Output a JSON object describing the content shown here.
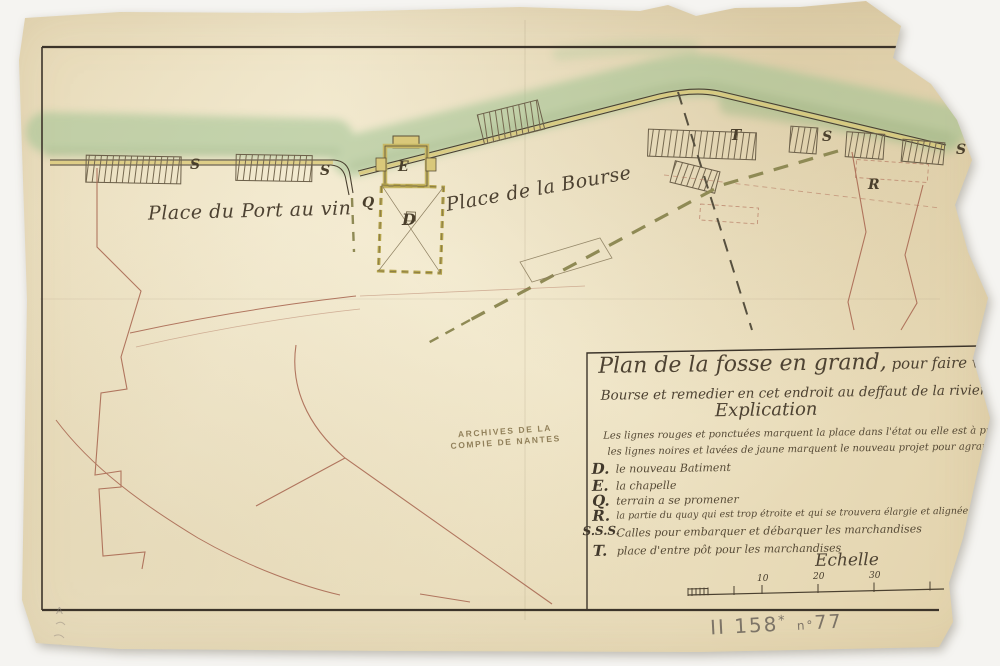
{
  "map_labels": {
    "place_port_au_vin": "Place du Port au vin",
    "place_de_la_bourse": "Place de la Bourse",
    "s_left_1": "S",
    "s_left_2": "S",
    "chapel_e": "E",
    "promenade_q": "Q",
    "building_d": "D",
    "entrepot_t": "T",
    "s_right_1": "S",
    "quay_r": "R",
    "s_right_2": "S"
  },
  "stamp": {
    "line1": "ARCHIVES DE LA",
    "line2": "COMPIE DE NANTES"
  },
  "title_block": {
    "title_line1_big": "Plan de la fosse en grand,",
    "title_line1_rest": " pour faire voir la maniere",
    "title_line2": "Bourse et remedier en cet endroit au deffaut de la riviere comme il est dit d",
    "heading": "Explication",
    "intro_line1": "Les lignes rouges et ponctuées marquent la place dans l'état ou elle est à présent,",
    "intro_line2": "les lignes noires et lavées de jaune marquent le nouveau projet pour agrandir c",
    "legend": [
      {
        "key": "D.",
        "text": "le nouveau Batiment"
      },
      {
        "key": "E.",
        "text": "la chapelle"
      },
      {
        "key": "Q.",
        "text": "terrain a se promener"
      },
      {
        "key": "R.",
        "text": "la partie du quay qui est trop étroite et qui se trouvera élargie et alignée par le nouv"
      },
      {
        "key": "S.S.S.",
        "text": "Calles pour embarquer et débarquer les marchandises"
      },
      {
        "key": "T.",
        "text": "place d'entre pôt pour les marchandises"
      }
    ],
    "scale": {
      "label": "Echelle",
      "ticks": [
        "10",
        "20",
        "30"
      ]
    }
  },
  "annotations": {
    "shelfmark": "II 158",
    "shelfmark_star": "*",
    "no_label": "n°",
    "number": "77",
    "corner_pencil": "A"
  },
  "colors": {
    "paper": "#ece1c4",
    "ink": "#41382b",
    "red_ink": "#aa6a54",
    "green_wash": "#9fc292",
    "yellow_wash": "#dcca7c",
    "pencil": "#6b635a",
    "stamp": "#8a7a52"
  }
}
